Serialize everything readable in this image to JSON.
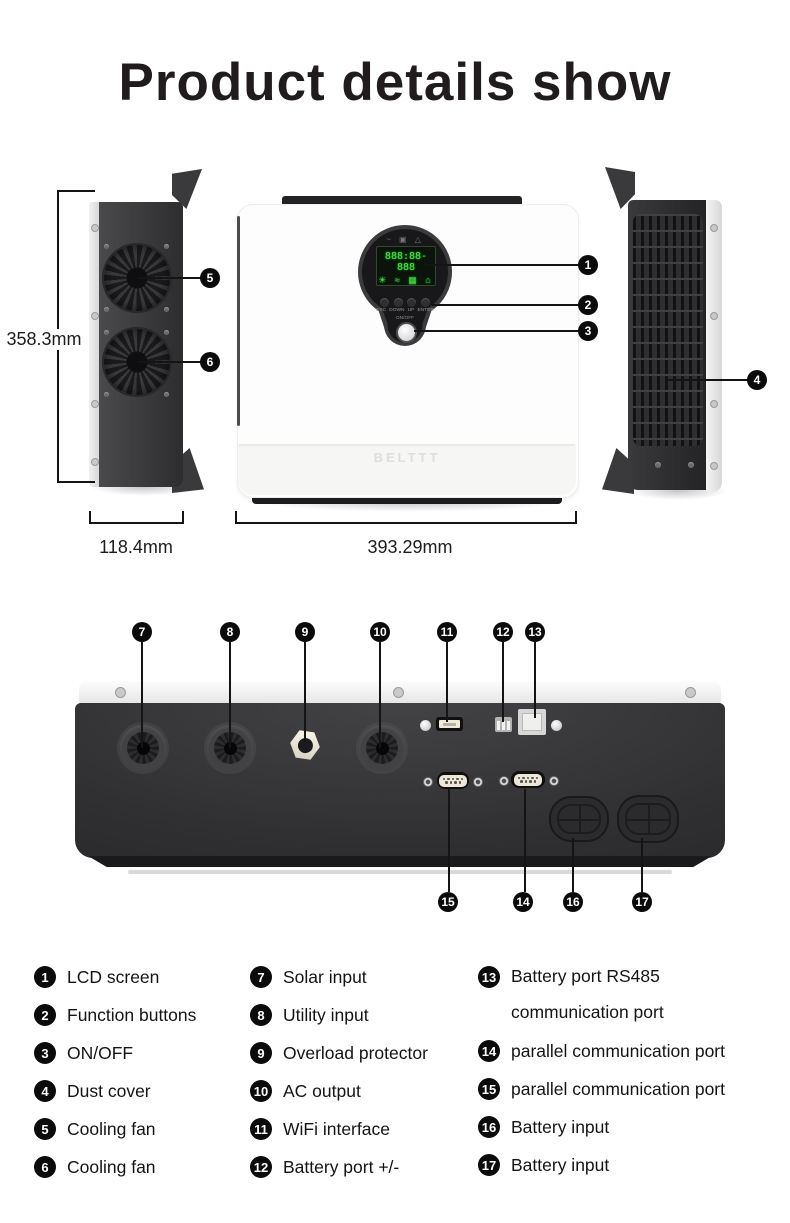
{
  "title": "Product details show",
  "brand_logo": "BELTTT",
  "dimensions": {
    "height": "358.3mm",
    "depth": "118.4mm",
    "width": "393.29mm"
  },
  "display": {
    "status_icons": "~ ▣ △",
    "lcd_readout": "888:88-888",
    "lcd_icons": "☀ ≈ ▦ ⌂",
    "buttons": [
      "ESC",
      "DOWN",
      "UP",
      "ENTER"
    ],
    "power_label": "ON/OFF"
  },
  "callouts": [
    "1",
    "2",
    "3",
    "4",
    "5",
    "6",
    "7",
    "8",
    "9",
    "10",
    "11",
    "12",
    "13",
    "14",
    "15",
    "16",
    "17"
  ],
  "legend": {
    "col1": [
      {
        "num": "1",
        "label": "LCD screen"
      },
      {
        "num": "2",
        "label": "Function buttons"
      },
      {
        "num": "3",
        "label": "ON/OFF"
      },
      {
        "num": "4",
        "label": "Dust cover"
      },
      {
        "num": "5",
        "label": "Cooling fan"
      },
      {
        "num": "6",
        "label": "Cooling fan"
      }
    ],
    "col2": [
      {
        "num": "7",
        "label": "Solar input"
      },
      {
        "num": "8",
        "label": "Utility input"
      },
      {
        "num": "9",
        "label": "Overload protector"
      },
      {
        "num": "10",
        "label": "AC output"
      },
      {
        "num": "11",
        "label": "WiFi interface"
      },
      {
        "num": "12",
        "label": "Battery port +/-"
      }
    ],
    "col3": [
      {
        "num": "13",
        "label": "Battery port RS485",
        "label2": "communication port"
      },
      {
        "num": "14",
        "label": "parallel communication port"
      },
      {
        "num": "15",
        "label": "parallel communication port"
      },
      {
        "num": "16",
        "label": "Battery input"
      },
      {
        "num": "17",
        "label": "Battery input"
      }
    ]
  }
}
